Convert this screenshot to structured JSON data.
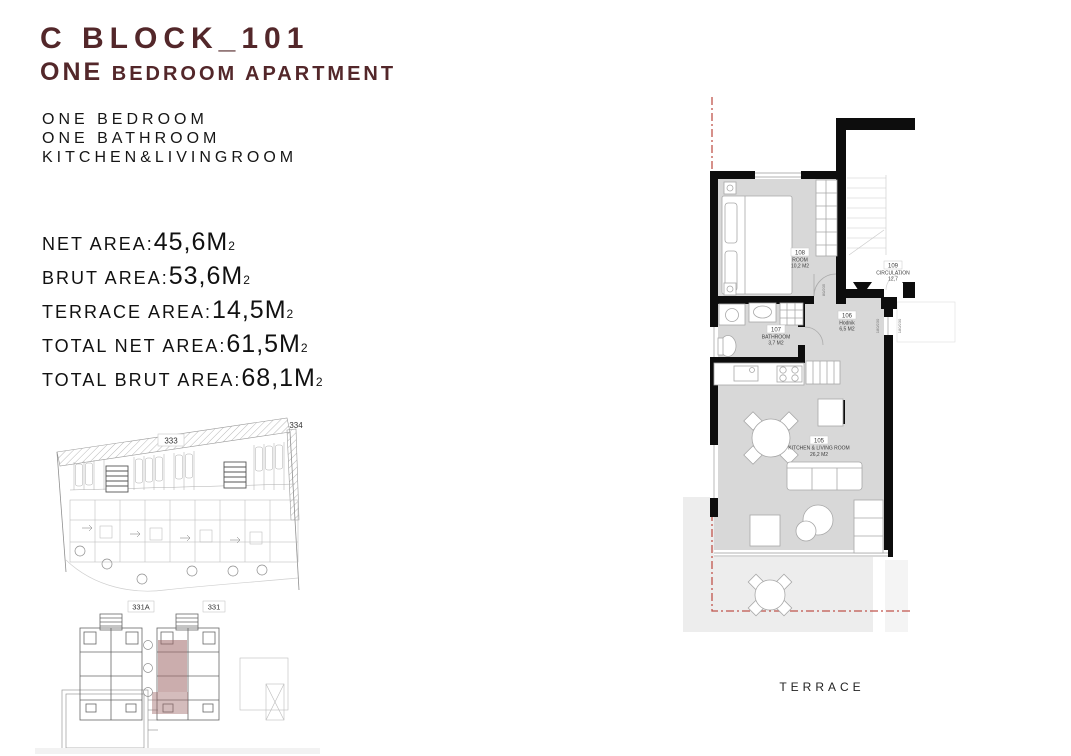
{
  "page": {
    "background": "#ffffff",
    "accent_color": "#53272a"
  },
  "header": {
    "block_title": "C BLOCK_101",
    "subtitle_lead": "ONE",
    "subtitle_rest": " BEDROOM APARTMENT"
  },
  "features": [
    "ONE BEDROOM",
    "ONE BATHROOM",
    "KITCHEN&LIVINGROOM"
  ],
  "areas": [
    {
      "label": "NET AREA:",
      "value": "45,6M",
      "sup": "2"
    },
    {
      "label": "BRUT AREA:",
      "value": "53,6M",
      "sup": "2"
    },
    {
      "label": "TERRACE AREA:",
      "value": "14,5M",
      "sup": "2"
    },
    {
      "label": "TOTAL NET AREA:",
      "value": "61,5M",
      "sup": "2"
    },
    {
      "label": "TOTAL BRUT AREA:",
      "value": "68,1M",
      "sup": "2"
    }
  ],
  "floor_plan": {
    "rooms": [
      {
        "number": "108",
        "name": "ROOM",
        "area": "10,2 M2"
      },
      {
        "number": "109",
        "name": "CIRCULATION",
        "area": "12,7"
      },
      {
        "number": "107",
        "name": "BATHROOM",
        "area": "3,7 M2"
      },
      {
        "number": "106",
        "name": "Hodnik",
        "area": "6,5 M2"
      },
      {
        "number": "105",
        "name": "KITCHEN & LIVING ROOM",
        "area": "26,2 M2"
      }
    ],
    "terrace_label": "TERRACE",
    "door_window_labels": [
      "180/230",
      "180/230",
      "80/205"
    ],
    "boundary_color": "#c0544c"
  },
  "site_plan": {
    "parcel_labels": [
      "333",
      "334"
    ],
    "building_labels": [
      "331A",
      "331"
    ],
    "highlight_color": "#a06a6a"
  }
}
